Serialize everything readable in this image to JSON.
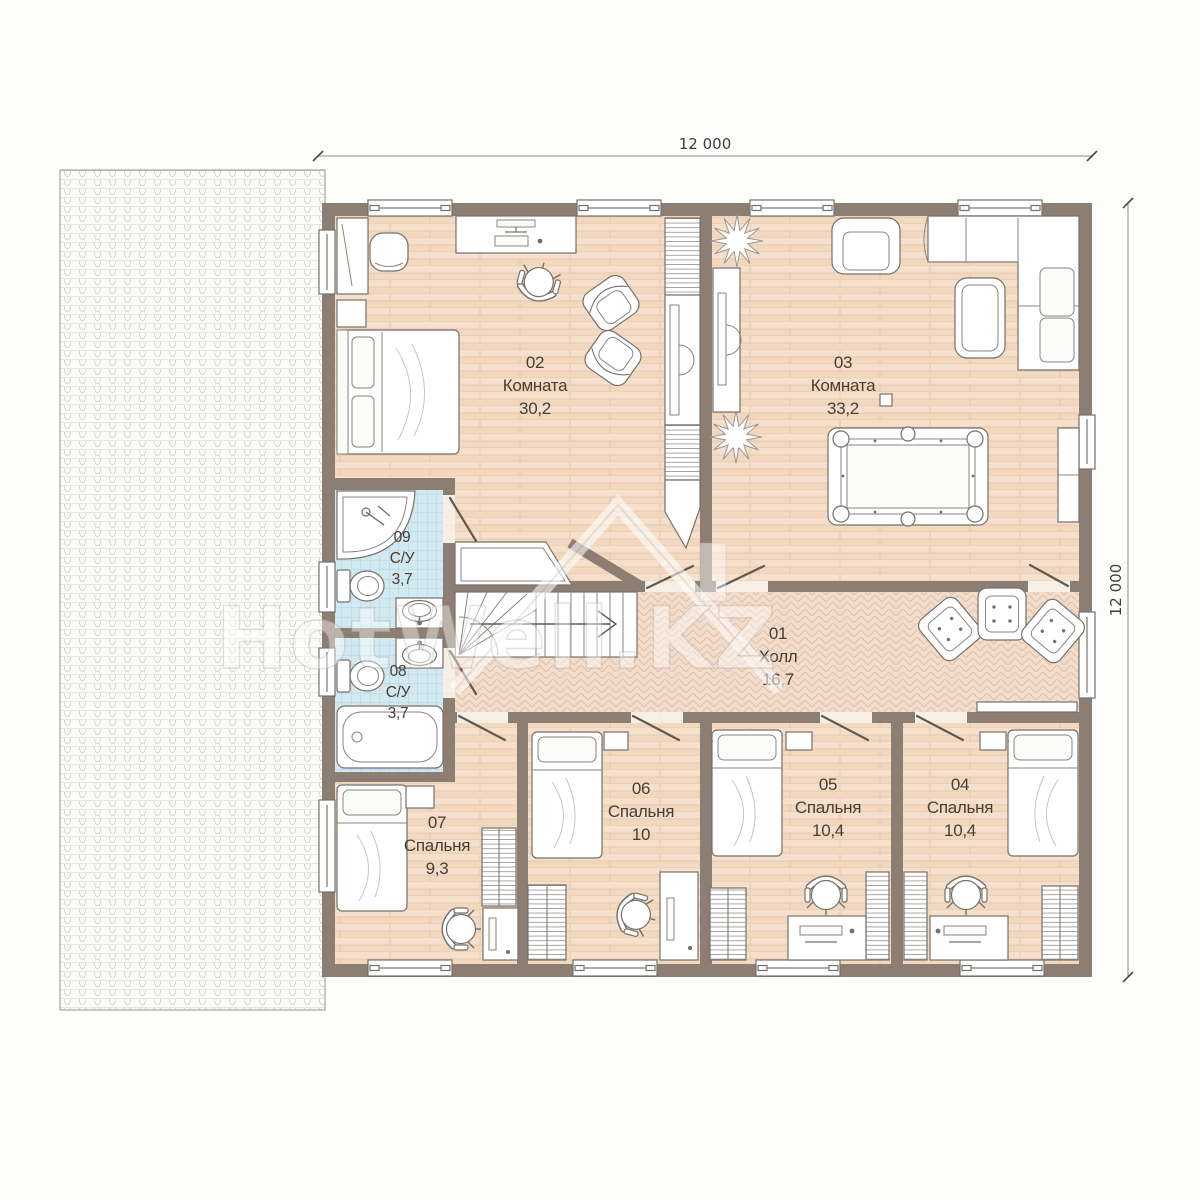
{
  "plan": {
    "floor_type": "floor-plan",
    "watermark": "HotWell.KZ",
    "dimensions": {
      "width_top": "12 000",
      "height_right": "12 000"
    },
    "rooms": [
      {
        "id": "01",
        "name": "Холл",
        "area": "16,7"
      },
      {
        "id": "02",
        "name": "Комната",
        "area": "30,2"
      },
      {
        "id": "03",
        "name": "Комната",
        "area": "33,2"
      },
      {
        "id": "04",
        "name": "Спальня",
        "area": "10,4"
      },
      {
        "id": "05",
        "name": "Спальня",
        "area": "10,4"
      },
      {
        "id": "06",
        "name": "Спальня",
        "area": "10"
      },
      {
        "id": "07",
        "name": "Спальня",
        "area": "9,3"
      },
      {
        "id": "08",
        "name": "С/У",
        "area": "3,7"
      },
      {
        "id": "09",
        "name": "С/У",
        "area": "3,7"
      }
    ],
    "colors": {
      "wall": "#8d7e73",
      "wood_floor": "#f5ddc8",
      "herringbone_floor": "#f3dcca",
      "tile_floor": "#d3e9f1",
      "roof": "#fbfbfa",
      "label_text": "#453f38"
    }
  }
}
